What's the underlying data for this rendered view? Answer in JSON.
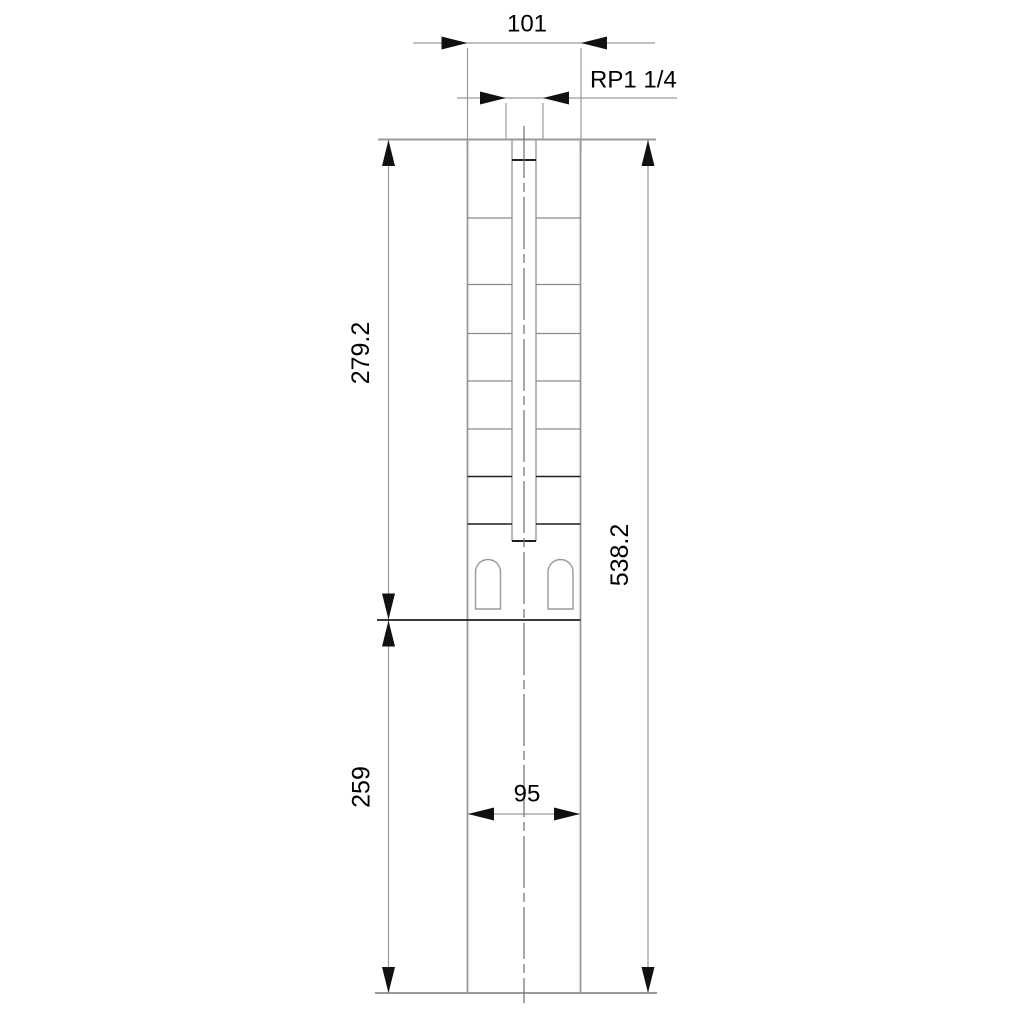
{
  "drawing": {
    "type": "technical-dimension-drawing",
    "subject": "submersible-borehole-pump-outline",
    "labels": {
      "width_top": "101",
      "thread": "RP1 1/4",
      "pump_length": "279.2",
      "total_length": "538.2",
      "motor_length": "259",
      "motor_width": "95"
    },
    "colors": {
      "background": "#ffffff",
      "outline_gray": "#9a9a9a",
      "stage_gray": "#8a8a8a",
      "stage_dark": "#1f1f1f",
      "centerline_gray": "#6e6e6e",
      "arrow_black": "#111111",
      "text_black": "#000000"
    }
  }
}
